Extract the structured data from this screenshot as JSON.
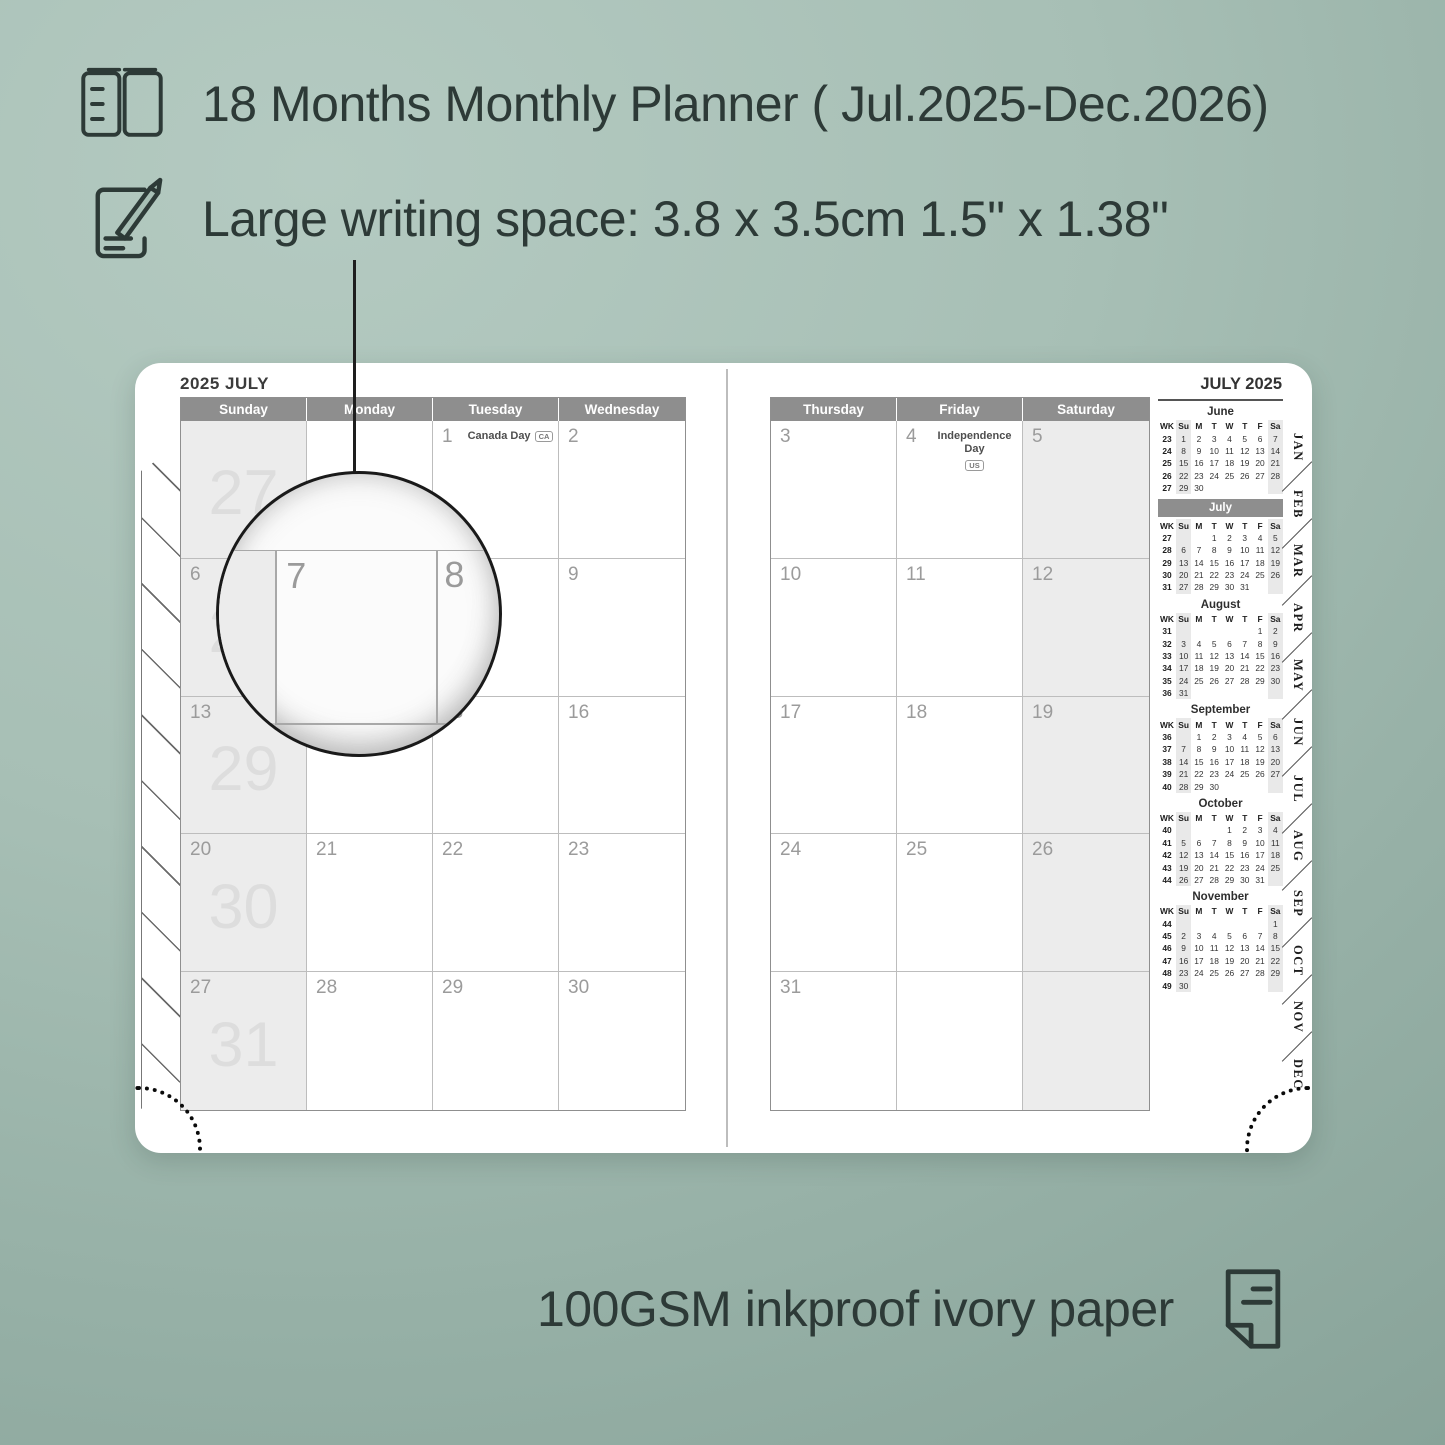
{
  "colors": {
    "background": "#a7bfb5",
    "text": "#2d3a37",
    "calendar_header": "#8e8e8e",
    "shaded_cell": "#ececec",
    "week_number": "#dddddd",
    "mini_highlight": "#8e8e8e"
  },
  "features": [
    {
      "icon": "open-book-icon",
      "text": "18 Months Monthly Planner ( Jul.2025-Dec.2026)"
    },
    {
      "icon": "pencil-note-icon",
      "text": "Large writing space: 3.8 x 3.5cm 1.5\" x 1.38\""
    }
  ],
  "footer": {
    "icon": "paper-sheet-icon",
    "text": "100GSM inkproof ivory paper"
  },
  "magnifier": {
    "dates": [
      "7",
      "8"
    ]
  },
  "planner": {
    "left_page": {
      "title": "2025 JULY",
      "day_headers": [
        "Sunday",
        "Monday",
        "Tuesday",
        "Wednesday"
      ],
      "rows": [
        [
          {
            "week": "27",
            "shaded": true
          },
          {},
          {
            "date": "1",
            "holiday": "Canada Day",
            "badge": "CA"
          },
          {
            "date": "2"
          }
        ],
        [
          {
            "date": "6",
            "week": "28",
            "shaded": true
          },
          {
            "date": "7"
          },
          {
            "date": "8"
          },
          {
            "date": "9"
          }
        ],
        [
          {
            "date": "13",
            "week": "29",
            "shaded": true
          },
          {
            "date": "14",
            "holiday": "Orangemen’s Day",
            "holiday2": "(NL)"
          },
          {
            "date": "15"
          },
          {
            "date": "16"
          }
        ],
        [
          {
            "date": "20",
            "week": "30",
            "shaded": true
          },
          {
            "date": "21"
          },
          {
            "date": "22"
          },
          {
            "date": "23"
          }
        ],
        [
          {
            "date": "27",
            "week": "31",
            "shaded": true
          },
          {
            "date": "28"
          },
          {
            "date": "29"
          },
          {
            "date": "30"
          }
        ]
      ]
    },
    "right_page": {
      "day_headers": [
        "Thursday",
        "Friday",
        "Saturday"
      ],
      "rows": [
        [
          {
            "date": "3"
          },
          {
            "date": "4",
            "holiday": "Independence Day",
            "badge": "US"
          },
          {
            "date": "5",
            "shaded": true
          }
        ],
        [
          {
            "date": "10"
          },
          {
            "date": "11"
          },
          {
            "date": "12",
            "shaded": true
          }
        ],
        [
          {
            "date": "17"
          },
          {
            "date": "18"
          },
          {
            "date": "19",
            "shaded": true
          }
        ],
        [
          {
            "date": "24"
          },
          {
            "date": "25"
          },
          {
            "date": "26",
            "shaded": true
          }
        ],
        [
          {
            "date": "31"
          },
          {},
          {
            "shaded": true
          }
        ]
      ]
    },
    "sidebar": {
      "title": "JULY 2025",
      "day_headers": [
        "WK",
        "Su",
        "M",
        "T",
        "W",
        "T",
        "F",
        "Sa"
      ],
      "mini_calendars": [
        {
          "name": "June",
          "weeks": [
            [
              "23",
              "1",
              "2",
              "3",
              "4",
              "5",
              "6",
              "7"
            ],
            [
              "24",
              "8",
              "9",
              "10",
              "11",
              "12",
              "13",
              "14"
            ],
            [
              "25",
              "15",
              "16",
              "17",
              "18",
              "19",
              "20",
              "21"
            ],
            [
              "26",
              "22",
              "23",
              "24",
              "25",
              "26",
              "27",
              "28"
            ],
            [
              "27",
              "29",
              "30",
              "",
              "",
              "",
              "",
              ""
            ]
          ]
        },
        {
          "name": "July",
          "highlight": true,
          "weeks": [
            [
              "27",
              "",
              "",
              "1",
              "2",
              "3",
              "4",
              "5"
            ],
            [
              "28",
              "6",
              "7",
              "8",
              "9",
              "10",
              "11",
              "12"
            ],
            [
              "29",
              "13",
              "14",
              "15",
              "16",
              "17",
              "18",
              "19"
            ],
            [
              "30",
              "20",
              "21",
              "22",
              "23",
              "24",
              "25",
              "26"
            ],
            [
              "31",
              "27",
              "28",
              "29",
              "30",
              "31",
              "",
              ""
            ]
          ]
        },
        {
          "name": "August",
          "weeks": [
            [
              "31",
              "",
              "",
              "",
              "",
              "",
              "1",
              "2"
            ],
            [
              "32",
              "3",
              "4",
              "5",
              "6",
              "7",
              "8",
              "9"
            ],
            [
              "33",
              "10",
              "11",
              "12",
              "13",
              "14",
              "15",
              "16"
            ],
            [
              "34",
              "17",
              "18",
              "19",
              "20",
              "21",
              "22",
              "23"
            ],
            [
              "35",
              "24",
              "25",
              "26",
              "27",
              "28",
              "29",
              "30"
            ],
            [
              "36",
              "31",
              "",
              "",
              "",
              "",
              "",
              ""
            ]
          ]
        },
        {
          "name": "September",
          "weeks": [
            [
              "36",
              "",
              "1",
              "2",
              "3",
              "4",
              "5",
              "6"
            ],
            [
              "37",
              "7",
              "8",
              "9",
              "10",
              "11",
              "12",
              "13"
            ],
            [
              "38",
              "14",
              "15",
              "16",
              "17",
              "18",
              "19",
              "20"
            ],
            [
              "39",
              "21",
              "22",
              "23",
              "24",
              "25",
              "26",
              "27"
            ],
            [
              "40",
              "28",
              "29",
              "30",
              "",
              "",
              "",
              ""
            ]
          ]
        },
        {
          "name": "October",
          "weeks": [
            [
              "40",
              "",
              "",
              "",
              "1",
              "2",
              "3",
              "4"
            ],
            [
              "41",
              "5",
              "6",
              "7",
              "8",
              "9",
              "10",
              "11"
            ],
            [
              "42",
              "12",
              "13",
              "14",
              "15",
              "16",
              "17",
              "18"
            ],
            [
              "43",
              "19",
              "20",
              "21",
              "22",
              "23",
              "24",
              "25"
            ],
            [
              "44",
              "26",
              "27",
              "28",
              "29",
              "30",
              "31",
              ""
            ]
          ]
        },
        {
          "name": "November",
          "weeks": [
            [
              "44",
              "",
              "",
              "",
              "",
              "",
              "",
              "1"
            ],
            [
              "45",
              "2",
              "3",
              "4",
              "5",
              "6",
              "7",
              "8"
            ],
            [
              "46",
              "9",
              "10",
              "11",
              "12",
              "13",
              "14",
              "15"
            ],
            [
              "47",
              "16",
              "17",
              "18",
              "19",
              "20",
              "21",
              "22"
            ],
            [
              "48",
              "23",
              "24",
              "25",
              "26",
              "27",
              "28",
              "29"
            ],
            [
              "49",
              "30",
              "",
              "",
              "",
              "",
              "",
              ""
            ]
          ]
        }
      ],
      "tabs": [
        "JAN",
        "FEB",
        "MAR",
        "APR",
        "MAY",
        "JUN",
        "JUL",
        "AUG",
        "SEP",
        "OCT",
        "NOV",
        "DEC"
      ]
    }
  }
}
